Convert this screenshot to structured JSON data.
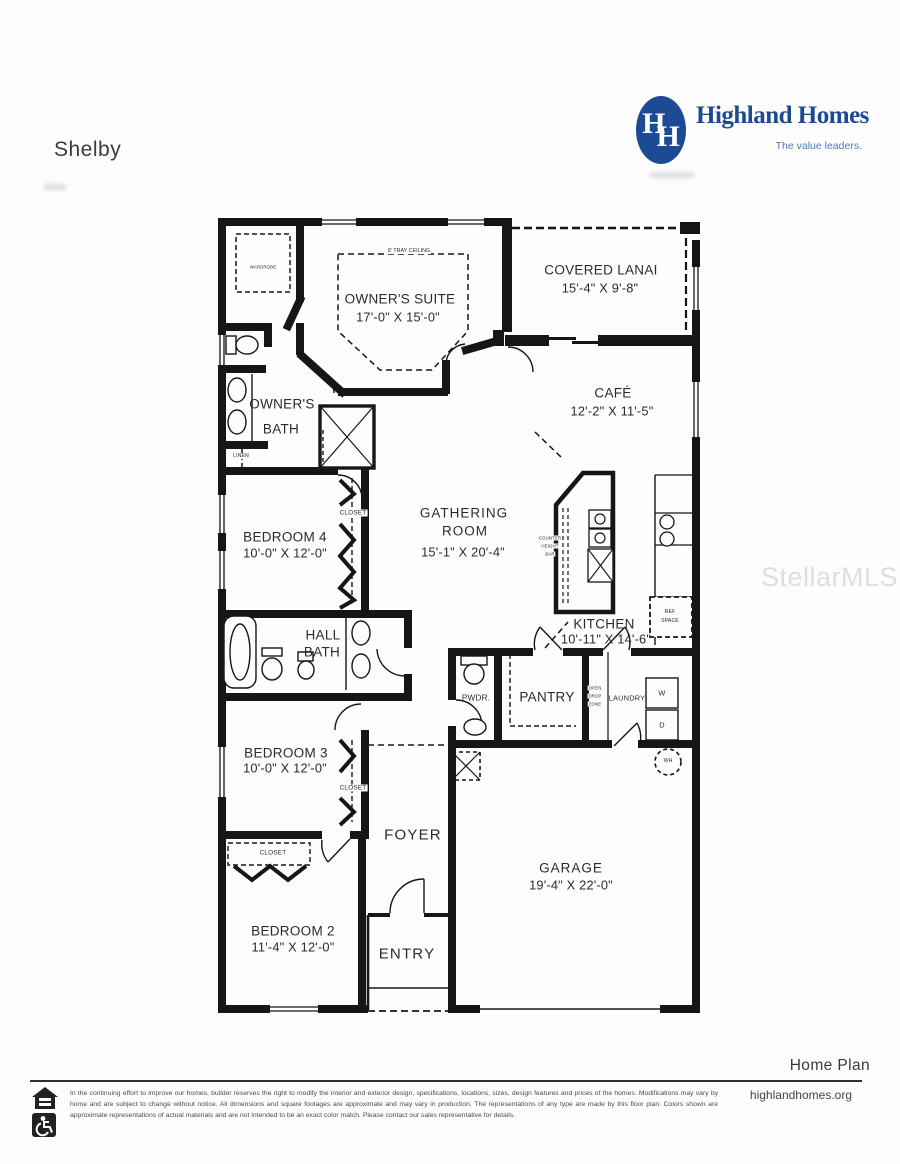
{
  "header": {
    "plan_name": "Shelby",
    "logo": {
      "monogram_left": "H",
      "monogram_right": "H",
      "brand": "Highland Homes",
      "tagline": "The value leaders.",
      "brand_color": "#1d4a94"
    }
  },
  "watermark": "StellarMLS",
  "rooms": {
    "owners_suite": {
      "note": "8' TRAY CEILING",
      "name": "OWNER'S SUITE",
      "dims": "17'-0\" X 15'-0\""
    },
    "covered_lanai": {
      "name": "COVERED LANAI",
      "dims": "15'-4\" X 9'-8\""
    },
    "cafe": {
      "name": "CAFÉ",
      "dims": "12'-2\" X 11'-5\""
    },
    "gathering_room": {
      "line1": "GATHERING",
      "line2": "ROOM",
      "dims": "15'-1\" X 20'-4\""
    },
    "owners_bath": {
      "line1": "OWNER'S",
      "line2": "BATH"
    },
    "bedroom4": {
      "name": "BEDROOM 4",
      "dims": "10'-0\" X 12'-0\""
    },
    "kitchen": {
      "name": "KITCHEN",
      "dims": "10'-11\" X 14'-6\""
    },
    "hall_bath": {
      "line1": "HALL",
      "line2": "BATH"
    },
    "pwdr": {
      "name": "PWDR."
    },
    "pantry": {
      "name": "PANTRY"
    },
    "laundry": {
      "name": "LAUNDRY"
    },
    "bedroom3": {
      "name": "BEDROOM 3",
      "dims": "10'-0\" X 12'-0\""
    },
    "foyer": {
      "name": "FOYER"
    },
    "bedroom2": {
      "name": "BEDROOM 2",
      "dims": "11'-4\" X 12'-0\""
    },
    "entry": {
      "name": "ENTRY"
    },
    "garage": {
      "name": "GARAGE",
      "dims": "19'-4\" X 22'-0\""
    }
  },
  "labels": {
    "wardrobe": "WARDROBE",
    "linen": "LINEN",
    "closet": "CLOSET",
    "counter_bar": [
      "COUNTER",
      "HEIGHT",
      "BAR"
    ],
    "drop_zone": [
      "OPEN",
      "DROP",
      "ZONE"
    ],
    "ref_space": [
      "REF",
      "SPACE"
    ],
    "washer": "W",
    "dryer": "D",
    "water_heater": "WH"
  },
  "footer": {
    "home_plan": "Home Plan",
    "website": "highlandhomes.org",
    "disclaimer": "In the continuing effort to improve our homes, builder reserves the right to modify the interior and exterior design, specifications, locations, sizes, design features and prices of the homes. Modifications may vary by home and are subject to change without notice. All dimensions and square footages are approximate and may vary in production. The representations of any type are made by this floor plan. Colors shown are approximate representations of actual materials and are not intended to be an exact color match. Please contact our sales representative for details."
  }
}
